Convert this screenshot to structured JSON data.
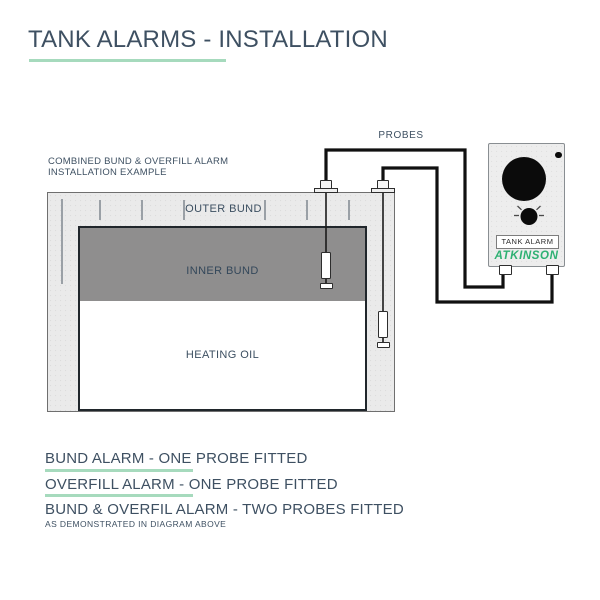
{
  "page": {
    "title": "TANK ALARMS - INSTALLATION"
  },
  "diagram": {
    "caption": {
      "line1": "COMBINED BUND & OVERFILL ALARM",
      "line2": "INSTALLATION EXAMPLE"
    },
    "probes_label": "PROBES",
    "tank": {
      "outer_label": "OUTER BUND",
      "inner_label": "INNER BUND",
      "oil_label": "HEATING OIL"
    },
    "device": {
      "name_plate": "TANK ALARM",
      "brand": "ATKINSON"
    },
    "probe_count": 2
  },
  "legend": {
    "items": [
      {
        "text": "BUND ALARM - ONE PROBE FITTED",
        "underlined": true
      },
      {
        "text": "OVERFILL ALARM - ONE PROBE FITTED",
        "underlined": true
      },
      {
        "text": "BUND & OVERFIL ALARM - TWO PROBES FITTED",
        "underlined": false
      }
    ],
    "note": "AS DEMONSTRATED IN DIAGRAM ABOVE"
  },
  "colors": {
    "heading_text": "#3e5062",
    "accent_underline": "#a6dabd",
    "brand_green": "#2eb173",
    "outer_bund_fill": "#eaeaea",
    "inner_bund_fill": "#8f8e8e",
    "wire": "#101010"
  }
}
